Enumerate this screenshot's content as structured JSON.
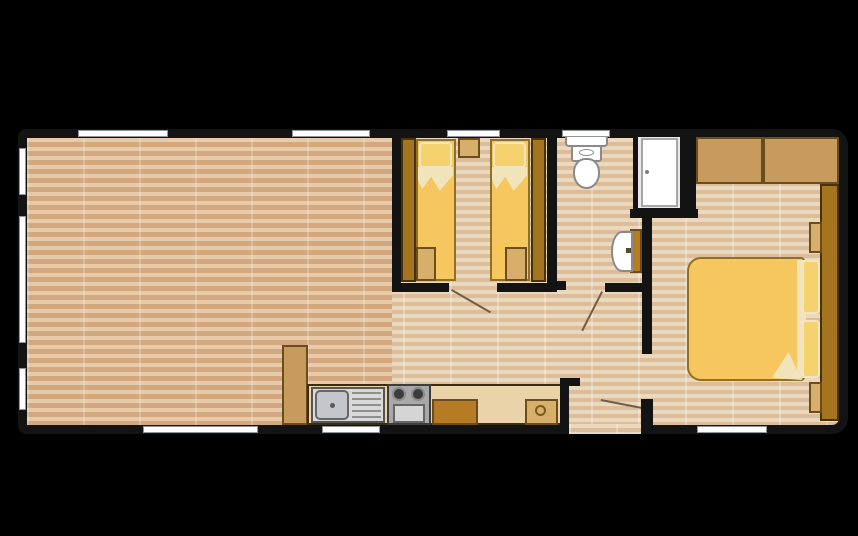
{
  "page": {
    "background": "#000000",
    "kind": "static-caravan-floor-plan",
    "description": "Top-down 2D floor plan of a two-bedroom static holiday home; no text labels rendered, shapes only"
  },
  "palette": {
    "page-bg": "#000000",
    "wall": "#131313",
    "window": "#fdfdfd",
    "window-border": "#8f959c",
    "floor-light-a": "#ecd8bc",
    "floor-light-b": "#dcbd9b",
    "floor-dark-a": "#e6caa9",
    "floor-dark-b": "#d3a87f",
    "wood-dark": "#a5741f",
    "wood-dark-border": "#46320c",
    "wood-mid": "#c79a5e",
    "wood-mid-border": "#6b4d1d",
    "wood-tan": "#d8ae6b",
    "counter": "#ead3a8",
    "counter-border": "#3b2d13",
    "cabinet-brown": "#b67c25",
    "bed-yellow": "#f5c75e",
    "bed-border": "#8f7026",
    "pillow": "#f6d26e",
    "pillow-border": "#f0e6c2",
    "linen": "#f2e4ba",
    "white-fixture": "#ffffff",
    "fixture-border": "#8a8a8a",
    "metal": "#d9d9d9",
    "metal-dark": "#a8a8a8",
    "burner": "#3c3c3c",
    "swing-line": "#6f5f48"
  },
  "rooms": [
    {
      "name": "living-dining-area",
      "floor": "horizontal-wood-planks",
      "windows": [
        "left-upper",
        "left-large-middle",
        "left-lower",
        "top-left",
        "top-right",
        "bottom-long"
      ]
    },
    {
      "name": "kitchen",
      "furniture": [
        "tall-larder-cabinet",
        "sink-unit-with-drainer",
        "two-burner-hob-with-oven",
        "base-cabinet",
        "worktop",
        "appliance-with-round-hatch"
      ],
      "windows": [
        "bottom-under-sink"
      ]
    },
    {
      "name": "twin-bedroom",
      "furniture": [
        "left-wardrobe",
        "left-single-bed",
        "central-bedside-unit",
        "right-single-bed",
        "right-wardrobe",
        "left-bed-foot-box",
        "right-bed-foot-box"
      ],
      "windows": [
        "top-centre"
      ],
      "doors": [
        "bottom-door-with-swing"
      ]
    },
    {
      "name": "shower-room",
      "furniture": [
        "toilet-with-cistern",
        "shower-cubicle-with-door",
        "wash-basin-on-partition"
      ],
      "windows": [
        "top-above-toilet"
      ],
      "doors": [
        "bottom-door-with-swing"
      ]
    },
    {
      "name": "hallway",
      "doors": [
        "main-entrance-bottom-opening",
        "master-bedroom-door-swing"
      ]
    },
    {
      "name": "master-bedroom",
      "furniture": [
        "overhead-cabinet-left",
        "overhead-cabinet-right",
        "tall-wardrobe-right-wall",
        "bedside-shelf-upper",
        "bedside-shelf-lower",
        "double-bed",
        "pillow-upper",
        "pillow-lower",
        "folded-duvet-corner"
      ],
      "windows": [
        "bottom-centre"
      ]
    }
  ]
}
